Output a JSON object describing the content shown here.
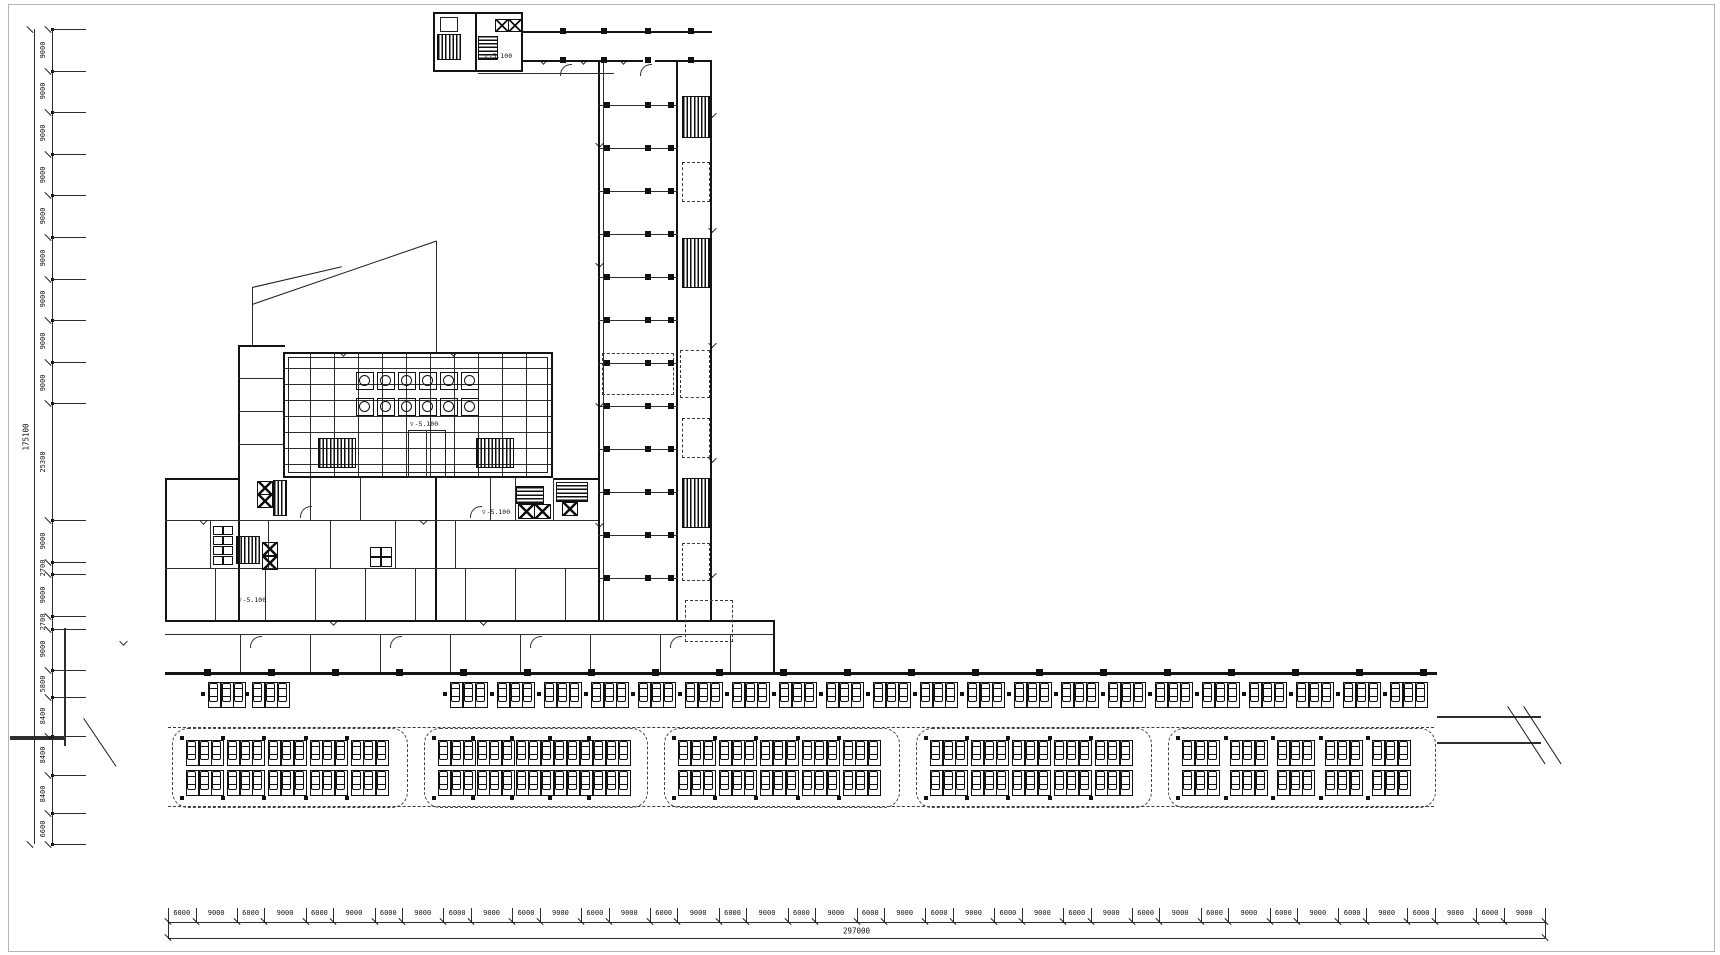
{
  "sheet": {
    "background": "#ffffff",
    "line_color": "#141414",
    "description_labels": {
      "level_marker_glyph": "▽"
    }
  },
  "dimensions": {
    "left": {
      "total": "175100",
      "segments": [
        "9000",
        "9000",
        "9000",
        "9000",
        "9000",
        "9000",
        "9000",
        "9000",
        "9000",
        "25300",
        "9000",
        "2700",
        "9000",
        "2700",
        "9000",
        "5800",
        "8400",
        "8400",
        "8400",
        "6600"
      ]
    },
    "bottom": {
      "total": "297000",
      "segments": [
        "6000",
        "9000",
        "6000",
        "9000",
        "6000",
        "9000",
        "6000",
        "9000",
        "6000",
        "9000",
        "6000",
        "9000",
        "6000",
        "9000",
        "6000",
        "9000",
        "6000",
        "9000",
        "6000",
        "9000",
        "6000",
        "9000",
        "6000",
        "9000",
        "6000",
        "9000",
        "6000",
        "9000",
        "6000",
        "9000",
        "6000",
        "9000",
        "6000",
        "9000",
        "6000",
        "9000",
        "6000",
        "9000",
        "6000",
        "9000"
      ]
    }
  },
  "level_markers": [
    "-5.100",
    "-5.100",
    "-5.100",
    "-5.100"
  ],
  "parking": {
    "top_row": {
      "clusters": 23,
      "stalls_per_cluster": 3
    },
    "islands": {
      "count": 5,
      "rows_per_island": 2,
      "clusters_per_row": 5,
      "stalls_per_cluster": 3
    }
  }
}
